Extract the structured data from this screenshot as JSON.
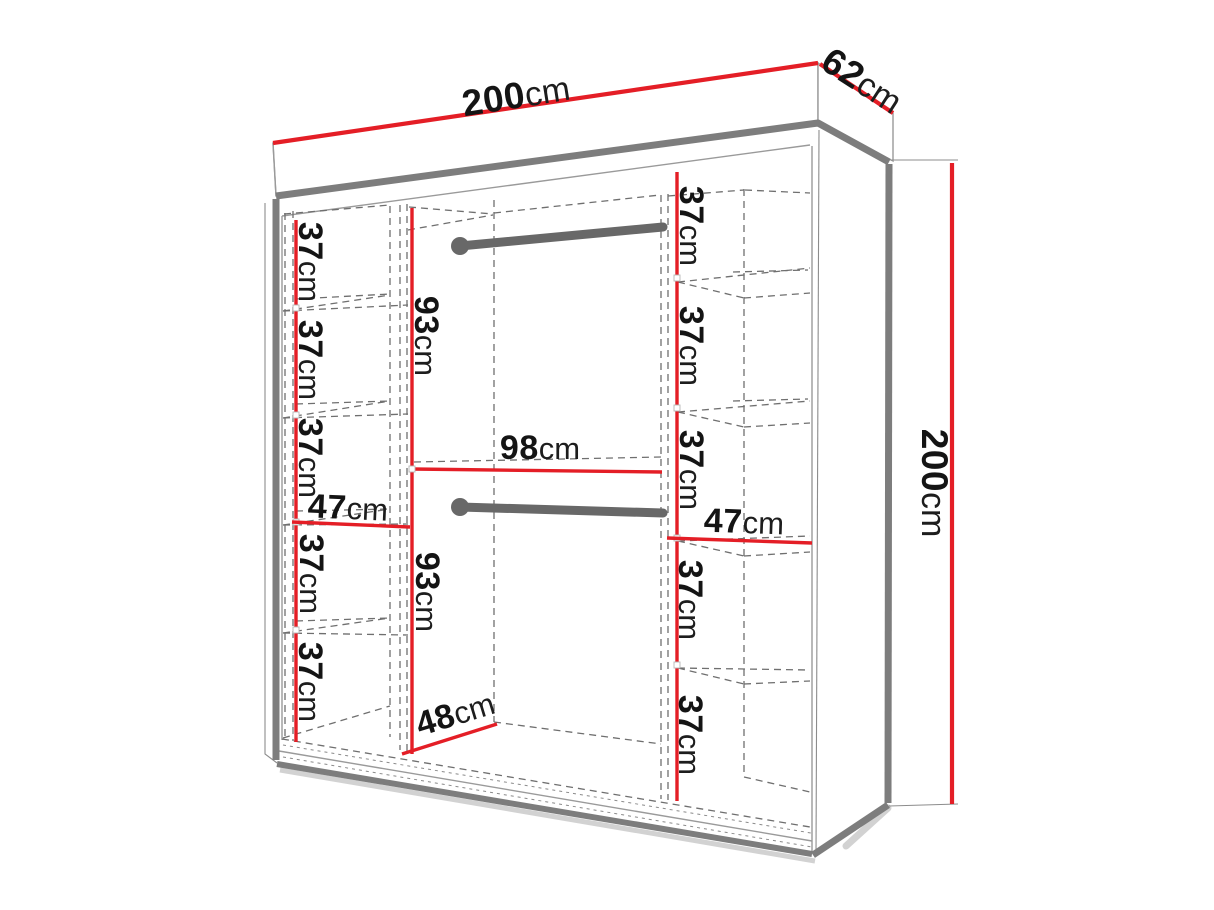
{
  "diagram": {
    "type": "wardrobe-dimension-drawing",
    "unit": "cm",
    "overall": {
      "width": {
        "value": "200",
        "unit": "cm"
      },
      "depth": {
        "value": "62",
        "unit": "cm"
      },
      "height": {
        "value": "200",
        "unit": "cm"
      }
    },
    "left_column": {
      "width": {
        "value": "47",
        "unit": "cm"
      },
      "shelf_heights": [
        {
          "value": "37",
          "unit": "cm"
        },
        {
          "value": "37",
          "unit": "cm"
        },
        {
          "value": "37",
          "unit": "cm"
        },
        {
          "value": "37",
          "unit": "cm"
        },
        {
          "value": "37",
          "unit": "cm"
        }
      ]
    },
    "right_column": {
      "width": {
        "value": "47",
        "unit": "cm"
      },
      "shelf_heights": [
        {
          "value": "37",
          "unit": "cm"
        },
        {
          "value": "37",
          "unit": "cm"
        },
        {
          "value": "37",
          "unit": "cm"
        },
        {
          "value": "37",
          "unit": "cm"
        },
        {
          "value": "37",
          "unit": "cm"
        }
      ]
    },
    "center_section": {
      "width": {
        "value": "98",
        "unit": "cm"
      },
      "depth": {
        "value": "48",
        "unit": "cm"
      },
      "upper_hanging_height": {
        "value": "93",
        "unit": "cm"
      },
      "lower_hanging_height": {
        "value": "93",
        "unit": "cm"
      }
    },
    "colors": {
      "dimension_line": "#e41e26",
      "structure": "#7d7d7d",
      "rail": "#686868",
      "dashed_line": "#6f6f6f",
      "text": "#141414",
      "background": "#ffffff"
    }
  }
}
